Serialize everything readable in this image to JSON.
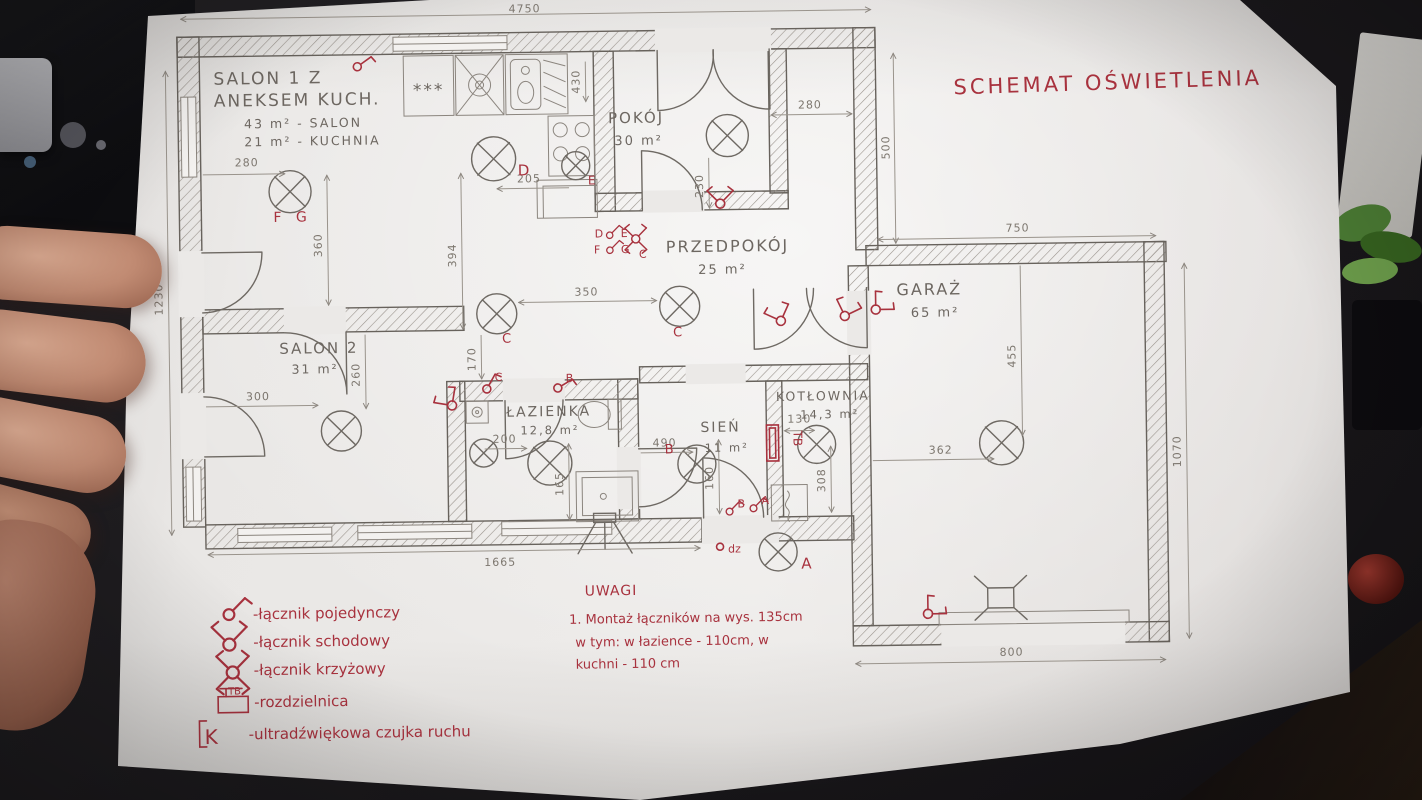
{
  "title": "SCHEMAT OŚWIETLENIA",
  "rooms": {
    "salon1": {
      "name_line1": "SALON 1 Z",
      "name_line2": "ANEKSEM KUCH.",
      "area_line1": "43 m² - SALON",
      "area_line2": "21 m² - KUCHNIA"
    },
    "pokoj": {
      "name": "POKÓJ",
      "area": "30 m²"
    },
    "przedpokoj": {
      "name": "PRZEDPOKÓJ",
      "area": "25 m²"
    },
    "garaz": {
      "name": "GARAŻ",
      "area": "65 m²"
    },
    "salon2": {
      "name": "SALON 2",
      "area": "31 m²"
    },
    "lazienka": {
      "name": "ŁAZIENKA",
      "area": "12,8 m²"
    },
    "sien": {
      "name": "SIEŃ",
      "area": "11 m²"
    },
    "kotlownia": {
      "name": "KOTŁOWNIA",
      "area": "14,3 m²"
    }
  },
  "dimensions": {
    "house_top": "4750",
    "house_left": "1230",
    "house_right": "500",
    "garage_top": "750",
    "garage_right": "1070",
    "garage_bottom": "800",
    "garage_lamp_v": "455",
    "garage_lamp_h": "362",
    "bottom_left": "1665",
    "salon1_lamp_h": "280",
    "salon1_lamp_v": "360",
    "kitchen_lamp_v": "394",
    "kitchen_lamp_h": "205",
    "kitchen_counter": "430",
    "pokoj_lamp_h": "280",
    "pokoj_lamp_v": "230",
    "hall_lamps": "350",
    "hall_lamp_v": "170",
    "salon2_lamp_h": "300",
    "salon2_lamp_v": "260",
    "bath_lamp_h": "200",
    "bath_shower_v": "165",
    "sien_h": "490",
    "sien_v": "160",
    "kotlownia_h": "130",
    "kotlownia_v": "308"
  },
  "lamp_labels": {
    "salon1": "F G",
    "kitchen_d": "D",
    "kitchen_e": "E",
    "przedpokoj": "C",
    "hall": "C",
    "sien": "B",
    "outdoor": "A"
  },
  "switch_labels": {
    "cluster_d": "D",
    "cluster_e": "E",
    "cluster_f": "F",
    "cluster_g": "G",
    "cluster_c": "C",
    "bath_c": "C",
    "bath_b": "B",
    "sien_b": "B",
    "sien_a": "A",
    "doorbell": "dz",
    "board": "TB"
  },
  "fixtures": {
    "freezer_stars": "***"
  },
  "legend": {
    "items": [
      {
        "label": "-łącznik pojedynczy"
      },
      {
        "label": "-łącznik schodowy"
      },
      {
        "label": "-łącznik krzyżowy"
      },
      {
        "label": "-rozdzielnica"
      },
      {
        "label": "-ultradźwiękowa czujka ruchu"
      }
    ],
    "board_symbol": "TB",
    "sensor_symbol": "K"
  },
  "notes": {
    "heading": "UWAGI",
    "line1": "1. Montaż łączników na wys. 135cm",
    "line2": "w tym: w łazience - 110cm, w",
    "line3": "kuchni - 110 cm"
  }
}
